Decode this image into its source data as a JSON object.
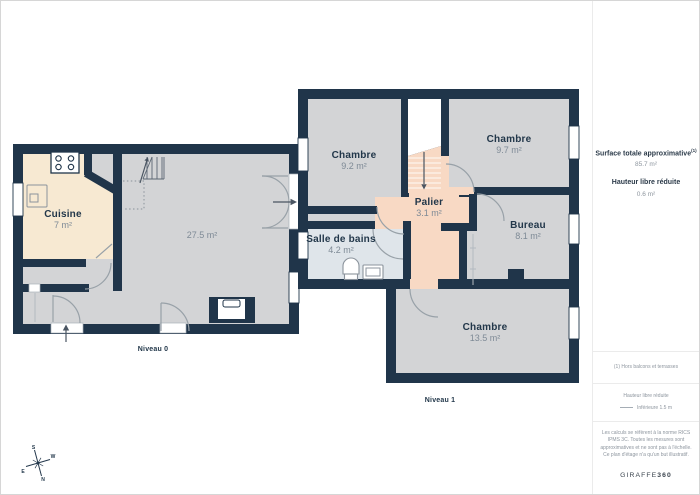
{
  "plans": {
    "level0": {
      "label": "Niveau 0",
      "rooms": [
        {
          "name": "Cuisine",
          "area": "7 m²"
        },
        {
          "name": "",
          "area": "27.5 m²"
        }
      ]
    },
    "level1": {
      "label": "Niveau 1",
      "rooms": [
        {
          "name": "Chambre",
          "area": "9.2 m²"
        },
        {
          "name": "Chambre",
          "area": "9.7 m²"
        },
        {
          "name": "Palier",
          "area": "3.1 m²"
        },
        {
          "name": "Salle de bains",
          "area": "4.2 m²"
        },
        {
          "name": "Bureau",
          "area": "8.1 m²"
        },
        {
          "name": "Chambre",
          "area": "13.5 m²"
        }
      ]
    }
  },
  "sidebar": {
    "surface_label": "Surface totale approximative",
    "surface_sup": "(1)",
    "surface_value": "85.7 m²",
    "height_label": "Hauteur libre réduite",
    "height_value": "0.6 m²",
    "footnote": "(1) Hors balcons et terrasses",
    "legend_title": "Hauteur libre réduite",
    "legend_item": "Inférieure 1.5 m",
    "disclaimer": "Les calculs se réfèrent à la norme RICS IPMS 3C. Toutes les mesures sont approximatives et ne sont pas à l'échelle. Ce plan d'étage n'a qu'un but illustratif.",
    "logo_prefix": "GIRAFFE",
    "logo_suffix": "360"
  },
  "compass": {
    "n": "N",
    "s": "S",
    "e": "E",
    "w": "W"
  },
  "colors": {
    "wall": "#20354a",
    "floor_gray": "#d3d4d6",
    "kitchen_cream": "#f7e9d2",
    "palier_peach": "#f8d9c4",
    "bathroom_blue": "#dfe5ea",
    "label_navy": "#22374a",
    "area_gray": "#7e8a96"
  }
}
